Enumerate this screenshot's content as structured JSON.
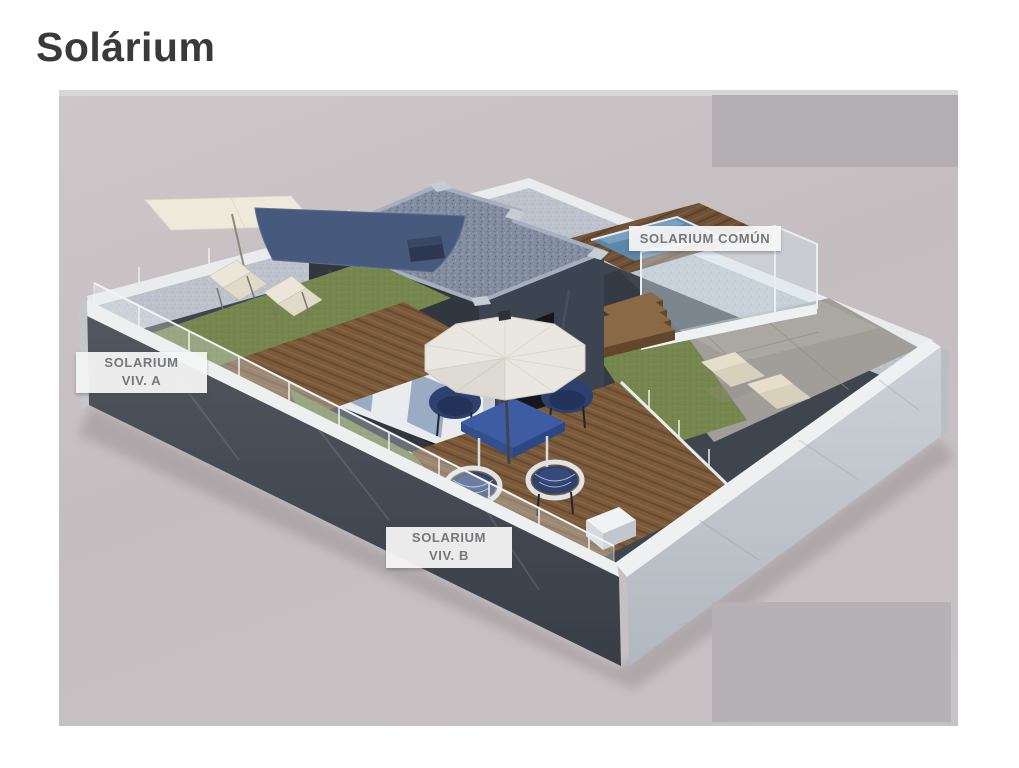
{
  "page": {
    "title": "Solárium"
  },
  "figure": {
    "description": "3D aerial rendering of a rooftop solarium with two private terraces and a shared pool area",
    "labels": {
      "comun": "SOLARIUM COMÚN",
      "viv_a": [
        "SOLARIUM",
        "VIV. A"
      ],
      "viv_b": [
        "SOLARIUM",
        "VIV. B"
      ]
    },
    "colors": {
      "background": "#c5bec0",
      "cover_gray": "#b3aeb1",
      "label_bg": "#f4f4f4",
      "label_text": "#75777a",
      "pool_water": "#5b87a9",
      "grass": "#75864e",
      "wood_deck": "#7a5a3a",
      "wood_deck_dark": "#6f5138",
      "building_wall": "#31363f",
      "building_wall_light": "#3c4452",
      "roof_gravel": "#838da0",
      "umbrella": "#e9e7df",
      "table_blue": "#3d5ca3",
      "furniture_blue": "#2e406d",
      "wall_light": "#c7ccd2",
      "slate_floor": "#3e454d",
      "stone_paving": "#a19e99"
    }
  }
}
